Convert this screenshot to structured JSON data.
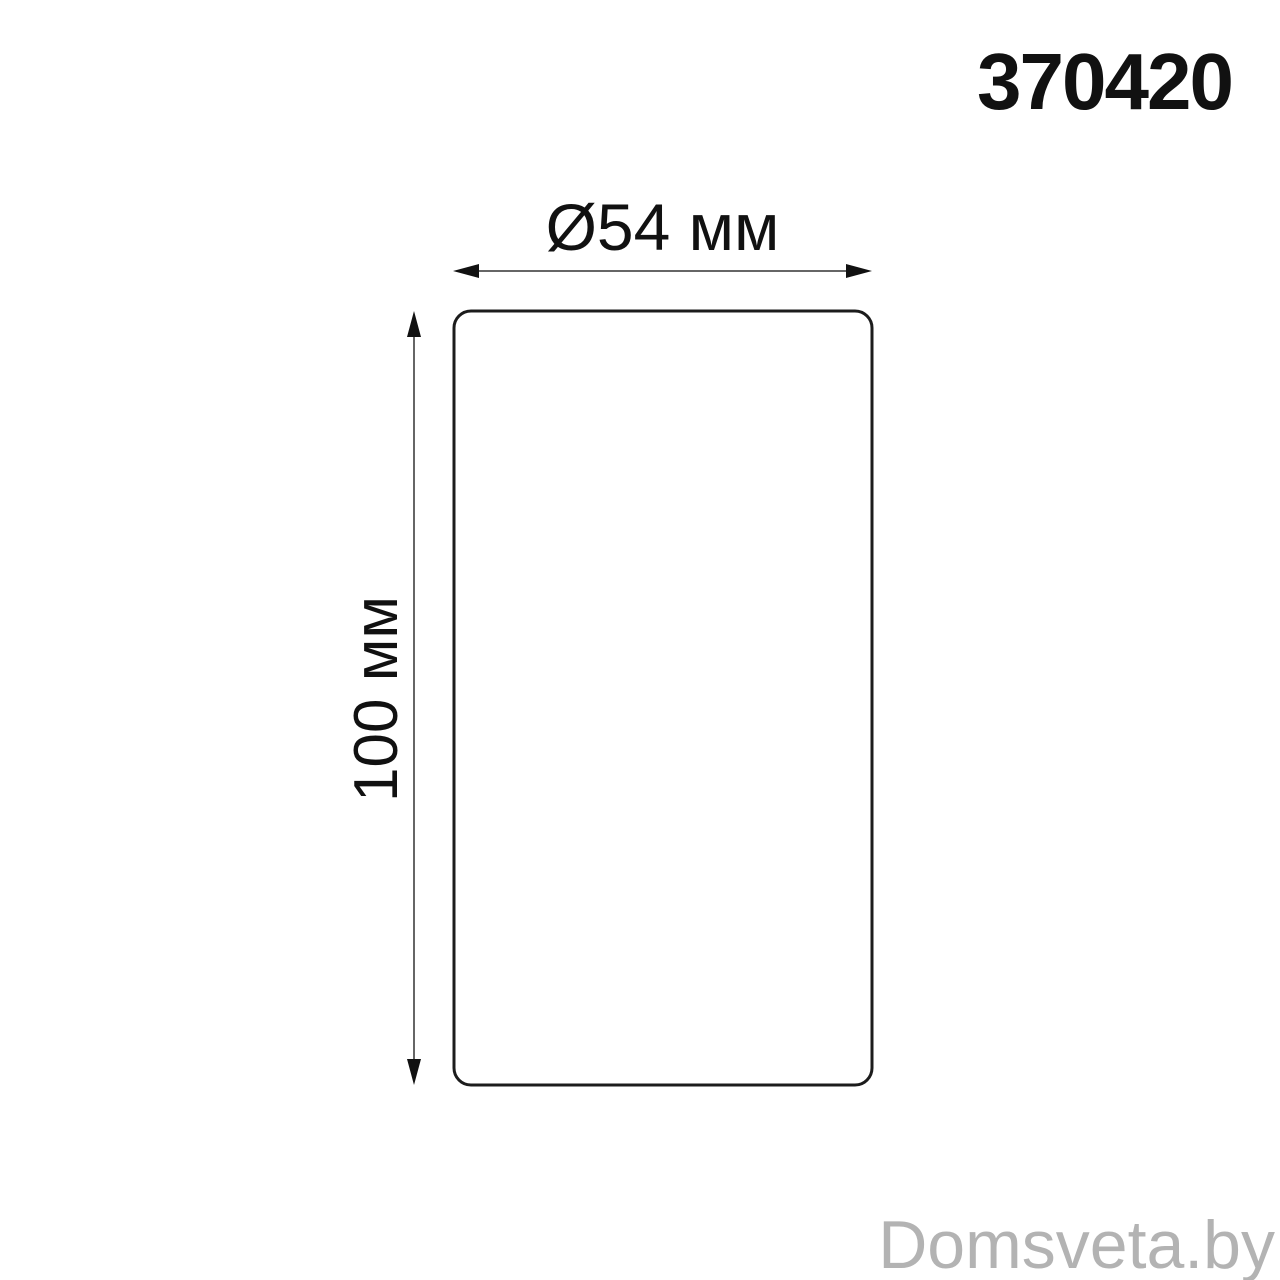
{
  "product": {
    "code": "370420"
  },
  "diagram": {
    "width_label": "Ø54 мм",
    "height_label": "100 мм"
  },
  "watermark": {
    "text": "Domsveta.by"
  },
  "colors": {
    "background": "#ffffff",
    "outline": "#1c1c1c",
    "dimension_line": "#666666",
    "arrowhead": "#111111",
    "text": "#111111",
    "watermark": "#b3b3b3"
  }
}
